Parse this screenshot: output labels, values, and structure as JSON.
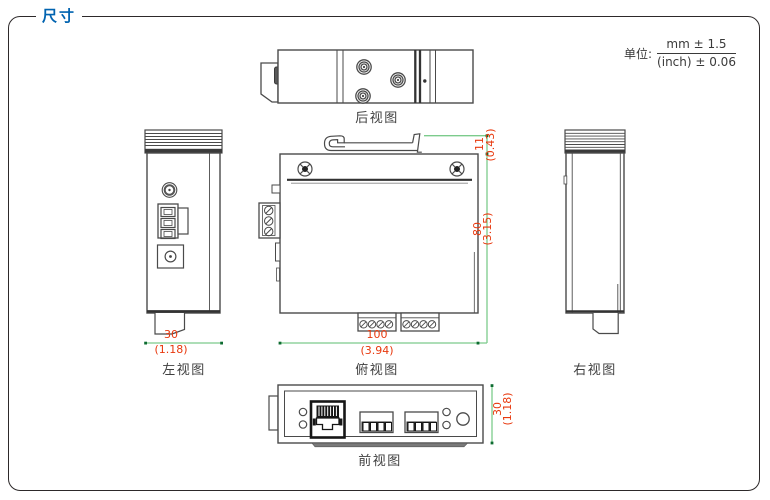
{
  "header": {
    "title": "尺寸"
  },
  "unit_note": {
    "label": "单位:",
    "mm": "mm ± 1.5",
    "inch": "(inch) ± 0.06"
  },
  "views": {
    "rear": {
      "label": "后视图"
    },
    "left": {
      "label": "左视图",
      "width_mm": "30",
      "width_inch": "(1.18)"
    },
    "top": {
      "label": "俯视图",
      "width_mm": "100",
      "width_inch": "(3.94)",
      "depth_mm": "80",
      "depth_inch": "(3.15)",
      "clip_mm": "11",
      "clip_inch": "(0.43)"
    },
    "right": {
      "label": "右视图"
    },
    "front": {
      "label": "前视图",
      "height_mm": "30",
      "height_inch": "(1.18)"
    }
  },
  "colors": {
    "title_blue": "#0063b0",
    "dimension_red": "#e8380d",
    "dimension_line_green": "#7ccb8c",
    "tick_green": "#0d6b30",
    "drawing_line": "#4a4a4a",
    "frame_border": "#2d292a"
  }
}
